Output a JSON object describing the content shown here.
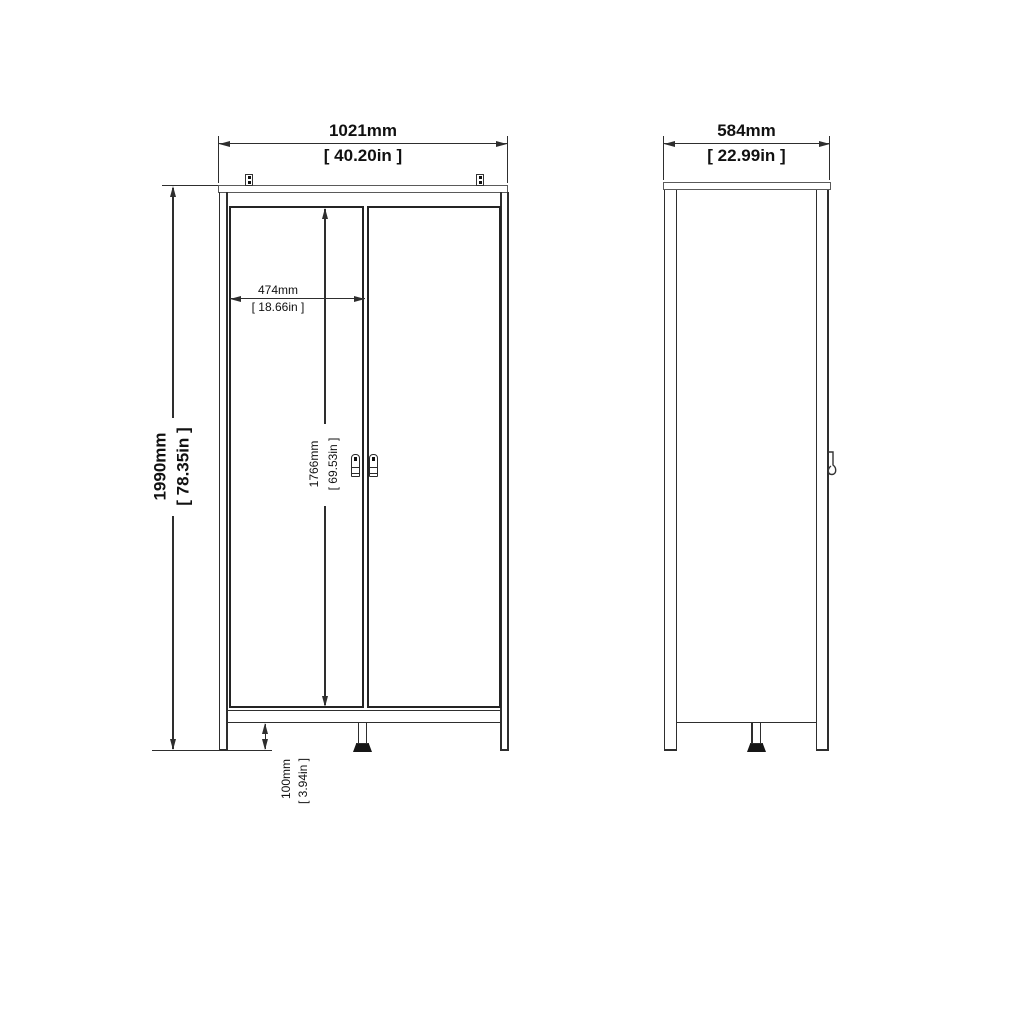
{
  "front": {
    "overall_width_mm": "1021mm",
    "overall_width_in": "[ 40.20in ]",
    "overall_height_mm": "1990mm",
    "overall_height_in": "[ 78.35in ]",
    "door_width_mm": "474mm",
    "door_width_in": "[ 18.66in ]",
    "door_height_mm": "1766mm",
    "door_height_in": "[ 69.53in ]",
    "leg_height_mm": "100mm",
    "leg_height_in": "[ 3.94in ]"
  },
  "side": {
    "depth_mm": "584mm",
    "depth_in": "[ 22.99in ]"
  },
  "colors": {
    "line": "#2e2e2e",
    "panel_line": "#5a5a5a",
    "text": "#111111",
    "background": "#ffffff"
  }
}
